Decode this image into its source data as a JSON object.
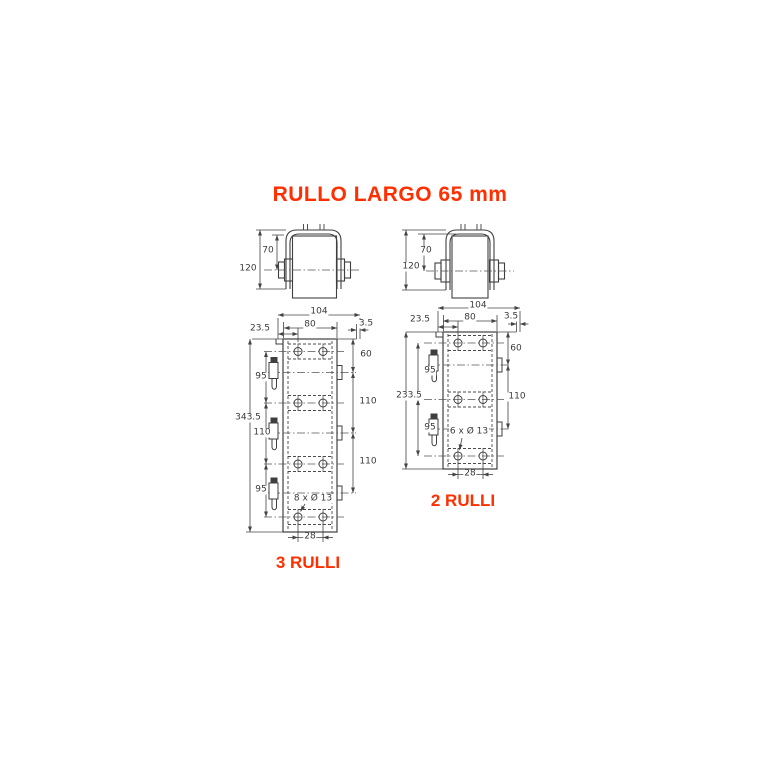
{
  "title": "RULLO LARGO 65 mm",
  "colors": {
    "accent": "#ff2f00",
    "line": "#3f3f3f"
  },
  "front_view_left": {
    "height_total": "120",
    "height_to_axle": "70"
  },
  "front_view_right": {
    "height_total": "120",
    "height_to_axle": "70"
  },
  "plate3": {
    "label": "3 RULLI",
    "holes_note": "8 x Ø 13",
    "width_overall": "104",
    "width_face": "80",
    "offset_left": "23.5",
    "offset_right": "3.5",
    "height_overall": "343.5",
    "left_chain": [
      "95",
      "110",
      "95"
    ],
    "right_chain": [
      "60",
      "110",
      "110"
    ],
    "hole_spacing": "28"
  },
  "plate2": {
    "label": "2 RULLI",
    "holes_note": "6 x Ø 13",
    "width_overall": "104",
    "width_face": "80",
    "offset_left": "23.5",
    "offset_right": "3.5",
    "height_overall": "233.5",
    "left_chain": [
      "95",
      "95"
    ],
    "right_chain": [
      "60",
      "110"
    ],
    "hole_spacing": "28"
  }
}
